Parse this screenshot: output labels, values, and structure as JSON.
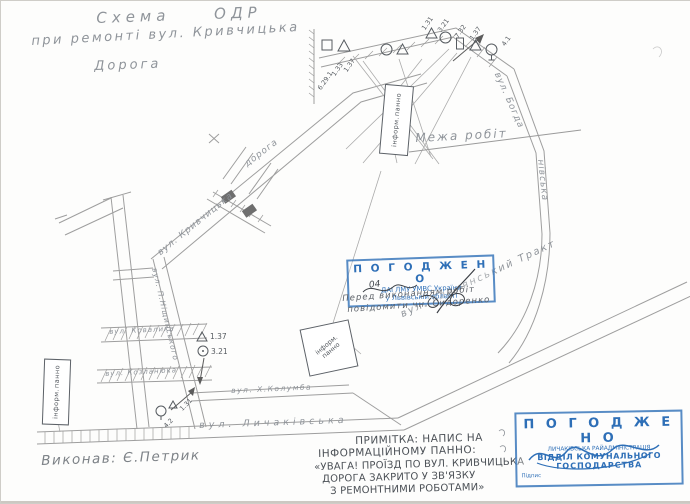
{
  "document": {
    "title_line1": "Схема ОДР",
    "title_line2": "при ремонті вул. Кривчицька",
    "title_line3": "Дорога",
    "author_note": "Виконав: Є.Петрик"
  },
  "streets": {
    "kryvchytska_part1": "вул. Кривчицька",
    "kryvchytska_part2": "дорога",
    "bohdanivska_part1": "вул. Богда",
    "bohdanivska_part2": "нівська",
    "hlynianskyi_trakt": "вул. Глинянський Тракт",
    "lychakivska": "вул. Личаківська",
    "nishchynskoho": "вул. П.Ніщинського",
    "kovalyka": "вул. Ковалика",
    "kozlanyuka": "вул. Козланюка",
    "kolumba": "вул. Х.Колумба"
  },
  "map_labels": {
    "work_boundary": "Межа робіт",
    "info_panel_line1": "інформ.",
    "info_panel_line2": "панно"
  },
  "signs": {
    "top_left": [
      "1.37",
      "1.33",
      "6.29.1"
    ],
    "top_right": [
      "1.31",
      "3.21",
      "7.32",
      "1.37",
      "4.1"
    ],
    "mid": [
      "1.37",
      "3.21"
    ],
    "bottom": [
      "1.31",
      "4.2"
    ]
  },
  "note": {
    "line1": "ПРИМІТКА: НАПИС НА",
    "line2": "ІНФОРМАЦІЙНОМУ ПАННО:",
    "line3": "«УВАГА! ПРОЇЗД ПО ВУЛ. КРИВЧИЦЬКА",
    "line4": "ДОРОГА ЗАКРИТО У ЗВ'ЯЗКУ",
    "line5": "З РЕМОНТНИМИ РОБОТАМИ»"
  },
  "stamps": {
    "dai": {
      "line1": "П О Г О Д Ж Е Н О",
      "line2": "ДАІ ЛМУ УМВС України",
      "line3": "у Львівській області",
      "handwritten_date": "04",
      "note_line1": "Перед виконанням робіт",
      "note_line2": "повідомити чн. Сидоренко",
      "color": "#2e6fb7"
    },
    "rayon": {
      "line1": "П О Г О Д Ж Е Н О",
      "line2": "ЛИЧАКІВСЬКА РАЙАДМІНІСТРАЦІЯ",
      "line3": "ВІДДІЛ КОМУНАЛЬНОГО",
      "line4": "ГОСПОДАРСТВА",
      "line5": "Підпис",
      "color": "#2e6fb7"
    }
  }
}
